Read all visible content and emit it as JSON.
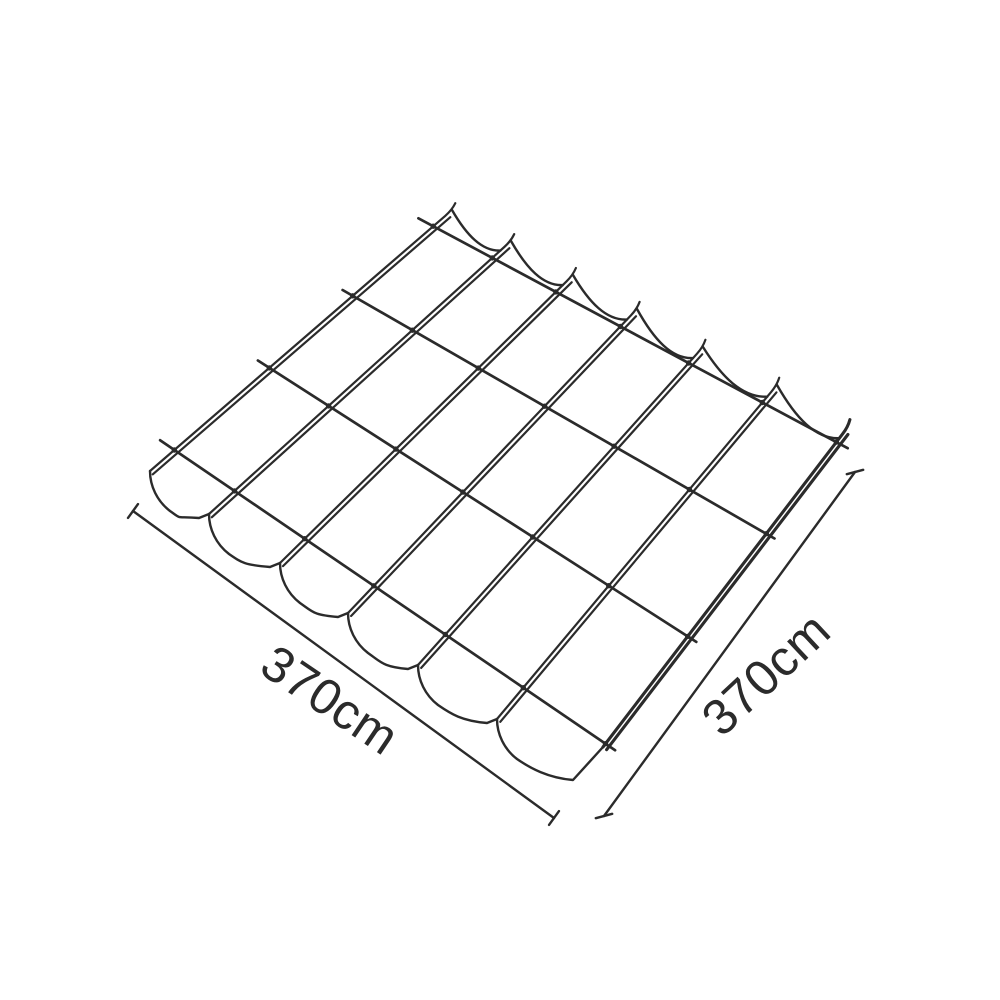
{
  "diagram": {
    "title": "pergola-wave-canopy-wireframe",
    "background_color": "#ffffff",
    "line_color": "#2b2b2b",
    "structure": {
      "rails": 7,
      "fabric_strips": 6,
      "cross_wires": 4
    },
    "dimensions": {
      "left": {
        "label": "370cm"
      },
      "right": {
        "label": "370cm"
      }
    }
  }
}
